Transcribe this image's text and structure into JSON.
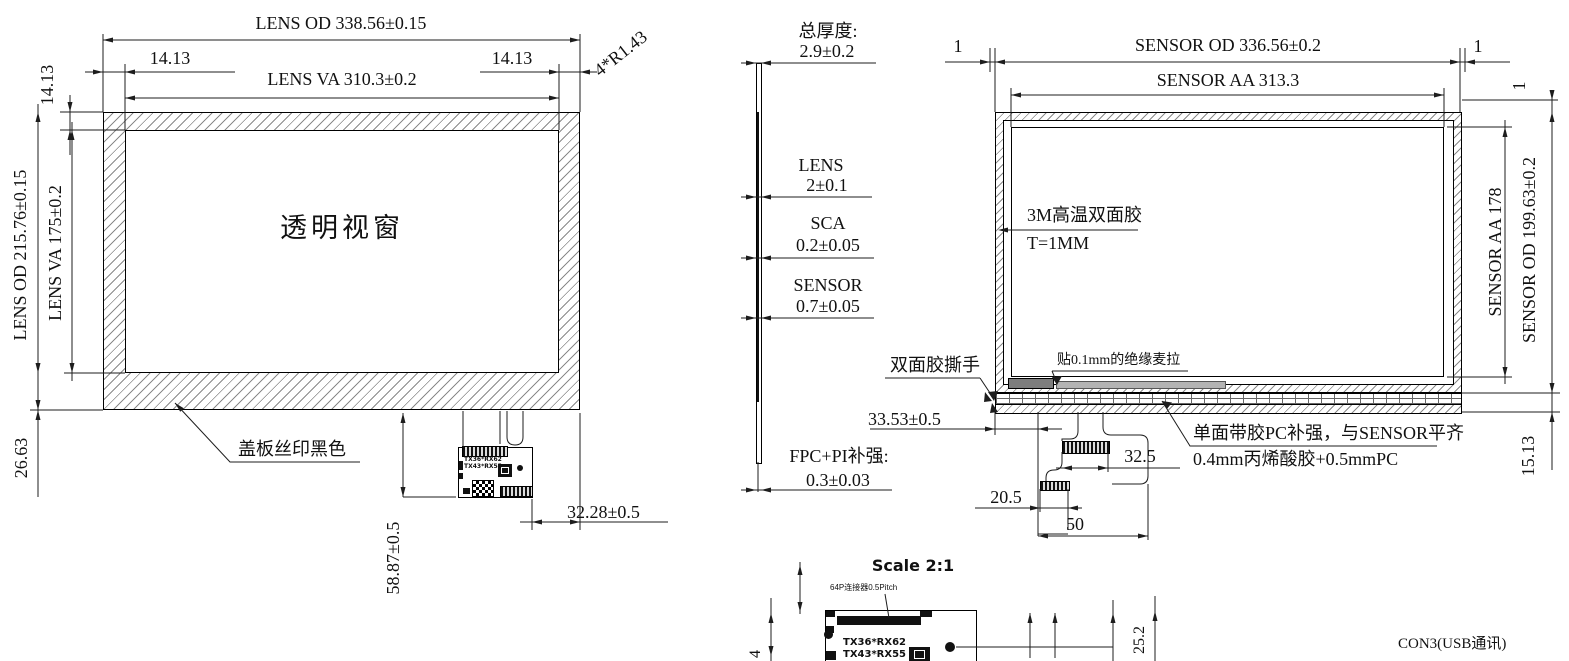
{
  "front_view": {
    "lens_od_h": "LENS OD 338.56±0.15",
    "margin_left": "14.13",
    "margin_right": "14.13",
    "lens_va_h": "LENS VA 310.3±0.2",
    "corner_radius": "4*R1.43",
    "margin_top_v": "14.13",
    "lens_od_v": "LENS OD 215.76±0.15",
    "lens_va_v": "LENS VA 175±0.2",
    "margin_bottom": "26.63",
    "window_label": "透明视窗",
    "cover_note": "盖板丝印黑色",
    "fpc_line1": "TX36*RX62",
    "fpc_line2": "TX43*RX55",
    "tail_height": "58.87±0.5",
    "tail_offset": "32.28±0.5"
  },
  "stackup": {
    "total_label": "总厚度:",
    "total_value": "2.9±0.2",
    "lens_label": "LENS",
    "lens_value": "2±0.1",
    "sca_label": "SCA",
    "sca_value": "0.2±0.05",
    "sensor_label": "SENSOR",
    "sensor_value": "0.7±0.05",
    "fpc_label": "FPC+PI补强:",
    "fpc_value": "0.3±0.03"
  },
  "back_view": {
    "inset_left": "1",
    "inset_right": "1",
    "inset_top": "1",
    "sensor_od_h": "SENSOR OD 336.56±0.2",
    "sensor_aa_h": "SENSOR AA 313.3",
    "tape_note_line1": "3M高温双面胶",
    "tape_note_line2": "T=1MM",
    "mylar_note": "贴0.1mm的绝缘麦拉",
    "tear_tab_note": "双面胶撕手",
    "fpc_offset": "33.53±0.5",
    "pc_note_line1": "单面带胶PC补强，与SENSOR平齐",
    "pc_note_line2": "0.4mm丙烯酸胶+0.5mmPC",
    "conn_width_upper": "32.5",
    "conn_width_lower": "20.5",
    "tail_width": "50",
    "sensor_aa_v": "SENSOR AA 178",
    "sensor_od_v": "SENSOR OD 199.63±0.2",
    "bottom_margin": "15.13"
  },
  "detail_view": {
    "scale_label": "Scale 2:1",
    "connector_note": "64P连接器0.5Pitch",
    "tx_line1": "TX36*RX62",
    "tx_line2": "TX43*RX55",
    "dim_height": "25.2",
    "dim_left": "4",
    "con3_label": "CON3(USB通讯)"
  }
}
